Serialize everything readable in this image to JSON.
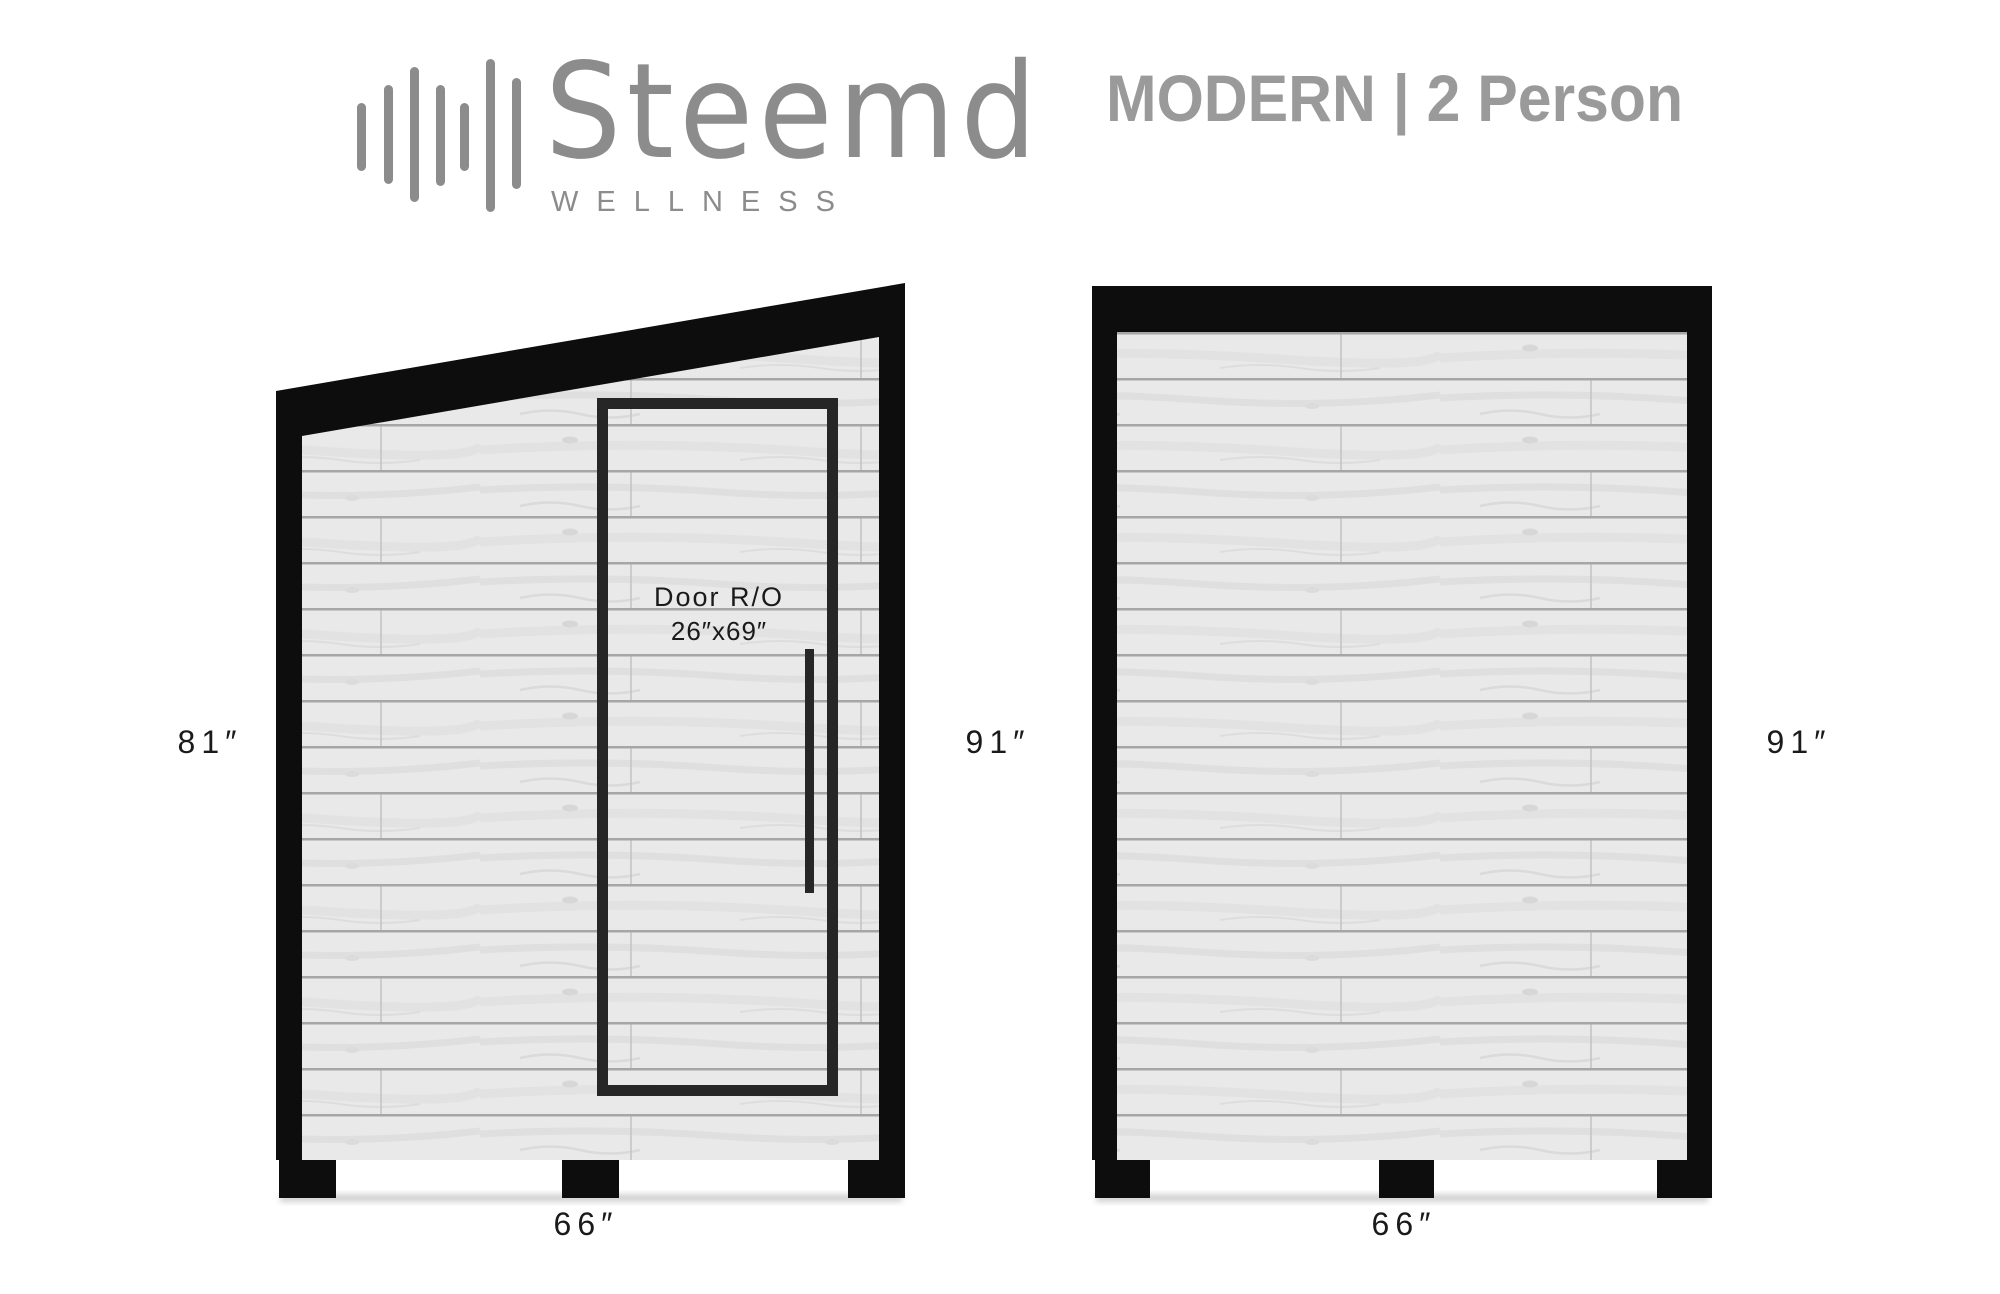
{
  "header": {
    "brand": {
      "name": "Steemd",
      "tagline": "WELLNESS",
      "icon": "soundwave-icon"
    },
    "model_title": "MODERN | 2 Person"
  },
  "side_view": {
    "label_height_left": "81″",
    "label_height_right": "91″",
    "label_width": "66″",
    "door": {
      "title": "Door R/O",
      "size": "26″x69″"
    }
  },
  "front_view": {
    "label_height_right": "91″",
    "label_width": "66″"
  },
  "colors": {
    "frame_black": "#0d0d0d",
    "door_frame": "#262626",
    "wood_base": "#e9e9e9",
    "plank_line": "#a6a6a6",
    "logo_gray": "#8c8c8c",
    "title_gray": "#9a9a9a",
    "dimension_text": "#1a1a1a"
  }
}
